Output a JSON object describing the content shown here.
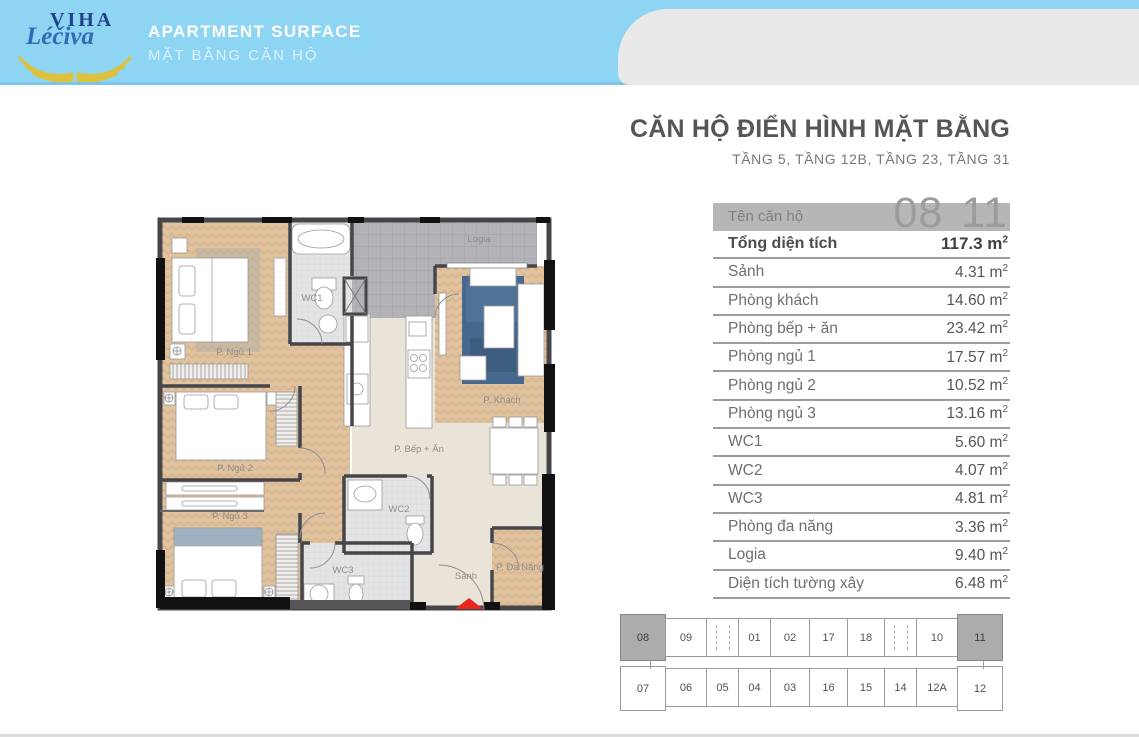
{
  "header": {
    "logo_line1": "VIHA",
    "logo_line2": "Léčiva",
    "title": "APARTMENT SURFACE",
    "subtitle": "MẶT BẰNG CĂN HỘ"
  },
  "panel": {
    "title": "CĂN HỘ ĐIỂN HÌNH MẶT BẰNG",
    "subtitle": "TẦNG 5, TẦNG 12B, TẦNG 23, TẦNG 31",
    "unit_row": {
      "label": "Tên căn hộ",
      "units": [
        "08",
        "11"
      ]
    },
    "rows": [
      {
        "label": "Tổng diện tích",
        "value": "117.3",
        "unit": "m²",
        "bold": true
      },
      {
        "label": "Sảnh",
        "value": "4.31",
        "unit": "m²"
      },
      {
        "label": "Phòng khách",
        "value": "14.60",
        "unit": "m²"
      },
      {
        "label": "Phòng bếp + ăn",
        "value": "23.42",
        "unit": "m²"
      },
      {
        "label": "Phòng ngủ 1",
        "value": "17.57",
        "unit": "m²"
      },
      {
        "label": "Phòng ngủ 2",
        "value": "10.52",
        "unit": "m²"
      },
      {
        "label": "Phòng ngủ 3",
        "value": "13.16",
        "unit": "m²"
      },
      {
        "label": "WC1",
        "value": "5.60",
        "unit": "m²"
      },
      {
        "label": "WC2",
        "value": "4.07",
        "unit": "m²"
      },
      {
        "label": "WC3",
        "value": "4.81",
        "unit": "m²"
      },
      {
        "label": "Phòng đa năng",
        "value": "3.36",
        "unit": "m²"
      },
      {
        "label": "Logia",
        "value": "9.40",
        "unit": "m²"
      },
      {
        "label": "Diện tích tường xây",
        "value": "6.48",
        "unit": "m²"
      }
    ]
  },
  "floorplan": {
    "rooms": [
      {
        "label": "P. Ngủ 1",
        "x": 82,
        "y": 157
      },
      {
        "label": "WC1",
        "x": 160,
        "y": 103
      },
      {
        "label": "Logia",
        "x": 327,
        "y": 44
      },
      {
        "label": "P. Khách",
        "x": 350,
        "y": 205
      },
      {
        "label": "P. Bếp + Ăn",
        "x": 267,
        "y": 254
      },
      {
        "label": "P. Ngủ 2",
        "x": 83,
        "y": 273
      },
      {
        "label": "P. Ngủ 3",
        "x": 78,
        "y": 321
      },
      {
        "label": "WC2",
        "x": 247,
        "y": 314
      },
      {
        "label": "WC3",
        "x": 191,
        "y": 375
      },
      {
        "label": "Sảnh",
        "x": 314,
        "y": 381
      },
      {
        "label": "P. Đa Năng",
        "x": 368,
        "y": 372
      }
    ]
  },
  "minimap": {
    "top": [
      {
        "label": "08",
        "highlight": true
      },
      {
        "label": "09"
      },
      {
        "shaft": true
      },
      {
        "label": "01"
      },
      {
        "label": "02"
      },
      {
        "label": "17"
      },
      {
        "label": "18"
      },
      {
        "shaft": true
      },
      {
        "label": "10"
      },
      {
        "label": "11",
        "highlight": true
      }
    ],
    "bottom": [
      {
        "label": "07",
        "tall": true
      },
      {
        "label": "06"
      },
      {
        "label": "05"
      },
      {
        "label": "04"
      },
      {
        "label": "03"
      },
      {
        "label": "16"
      },
      {
        "label": "15"
      },
      {
        "label": "14"
      },
      {
        "label": "12A"
      },
      {
        "label": "12",
        "tall": true
      }
    ],
    "cell_widths": [
      46,
      42,
      33,
      33,
      40,
      39,
      38,
      33,
      42,
      46
    ]
  },
  "colors": {
    "header_blue": "#8ed5f3",
    "logo_navy": "#22408e",
    "logo_script_blue": "#2e6db4",
    "logo_gold": "#ddc23f",
    "panel_gray": "#e9e9ea",
    "bar_gray": "#b5b6b7",
    "text_dark": "#55565a",
    "text_mid": "#6d6e71",
    "wall_dark": "#46464a",
    "wood_floor": "#e0c29e",
    "logia_gray": "#b2b2b7",
    "rug_blue": "#46688e",
    "wc_tile": "#e4e4e4",
    "kitchen_beige": "#eae3d7",
    "highlight_cell": "#acacac",
    "entrance_red": "#e8281e"
  }
}
